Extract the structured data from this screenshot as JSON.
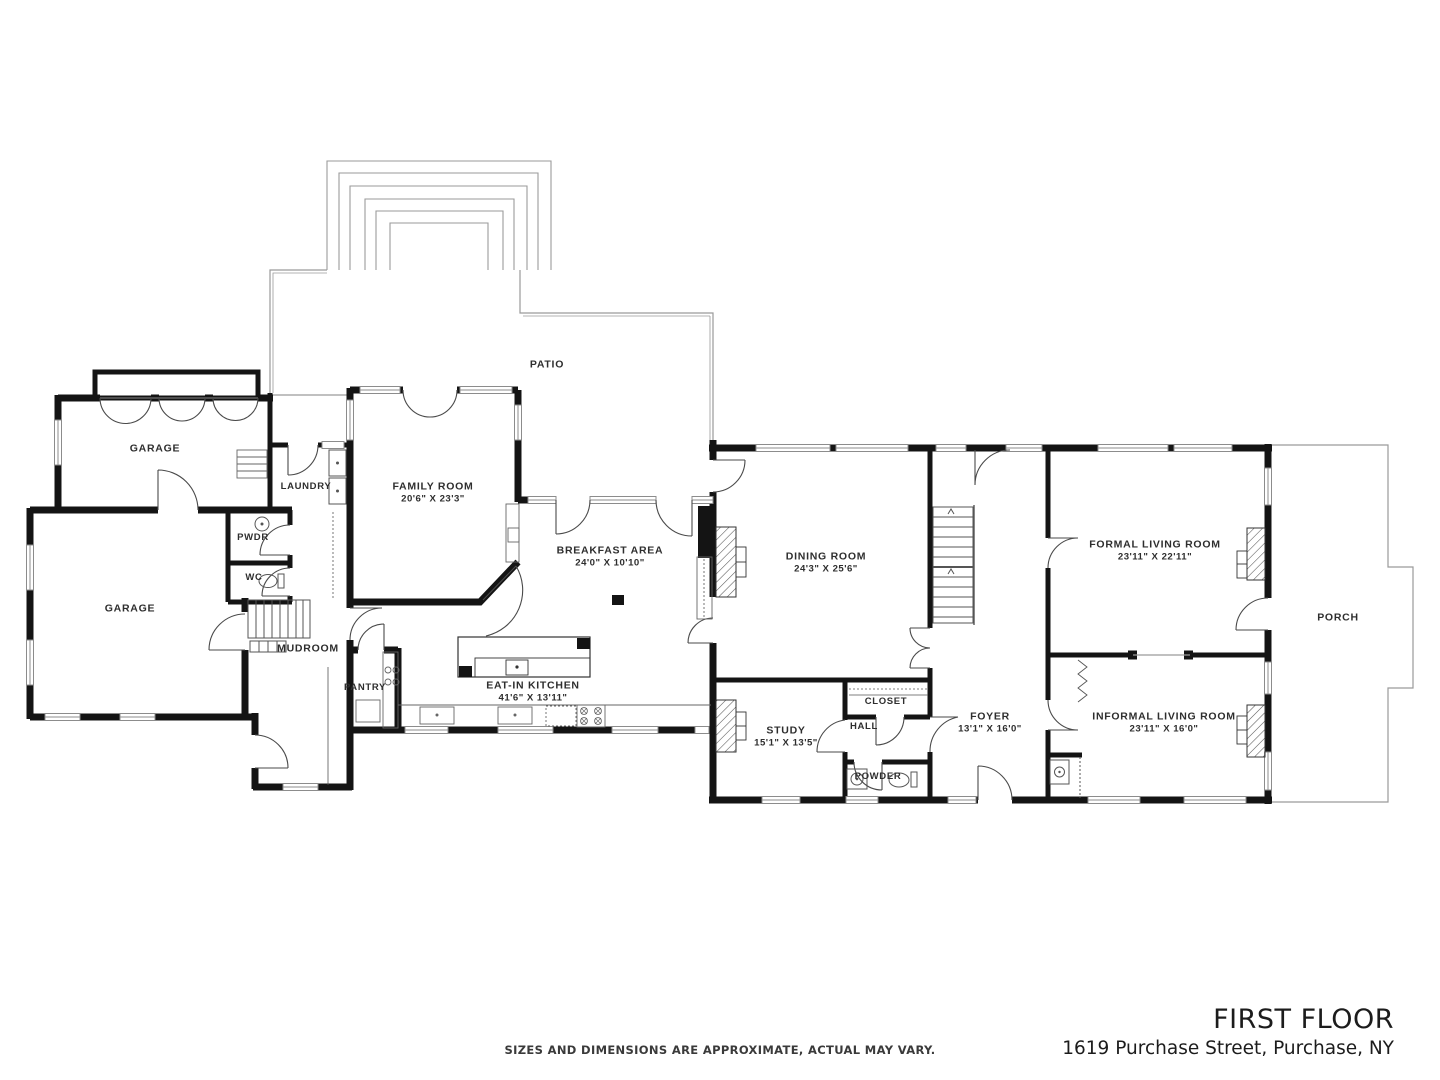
{
  "page": {
    "background": "#ffffff"
  },
  "footer": {
    "title": "FIRST FLOOR",
    "address": "1619 Purchase Street, Purchase, NY",
    "disclaimer": "SIZES AND DIMENSIONS ARE APPROXIMATE, ACTUAL MAY VARY."
  },
  "plan": {
    "colors": {
      "wall": "#141414",
      "thin_line": "#999999",
      "label_text": "#2e2e2e"
    },
    "rooms": [
      {
        "id": "garage-upper",
        "name": "GARAGE",
        "dims": ""
      },
      {
        "id": "garage-lower",
        "name": "GARAGE",
        "dims": ""
      },
      {
        "id": "laundry",
        "name": "LAUNDRY",
        "dims": ""
      },
      {
        "id": "pwdr",
        "name": "PWDR",
        "dims": ""
      },
      {
        "id": "wc",
        "name": "WC",
        "dims": ""
      },
      {
        "id": "mudroom",
        "name": "MUDROOM",
        "dims": ""
      },
      {
        "id": "pantry",
        "name": "PANTRY",
        "dims": ""
      },
      {
        "id": "family-room",
        "name": "FAMILY ROOM",
        "dims": "20'6\" X 23'3\""
      },
      {
        "id": "breakfast-area",
        "name": "BREAKFAST AREA",
        "dims": "24'0\" X 10'10\""
      },
      {
        "id": "eat-in-kitchen",
        "name": "EAT-IN KITCHEN",
        "dims": "41'6\" X 13'11\""
      },
      {
        "id": "patio",
        "name": "PATIO",
        "dims": ""
      },
      {
        "id": "dining-room",
        "name": "DINING ROOM",
        "dims": "24'3\" X 25'6\""
      },
      {
        "id": "study",
        "name": "STUDY",
        "dims": "15'1\" X 13'5\""
      },
      {
        "id": "closet",
        "name": "CLOSET",
        "dims": ""
      },
      {
        "id": "hall",
        "name": "HALL",
        "dims": ""
      },
      {
        "id": "powder",
        "name": "POWDER",
        "dims": ""
      },
      {
        "id": "foyer",
        "name": "FOYER",
        "dims": "13'1\" X 16'0\""
      },
      {
        "id": "formal-living-room",
        "name": "FORMAL LIVING ROOM",
        "dims": "23'11\" X 22'11\""
      },
      {
        "id": "informal-living-room",
        "name": "INFORMAL LIVING ROOM",
        "dims": "23'11\" X 16'0\""
      },
      {
        "id": "porch",
        "name": "PORCH",
        "dims": ""
      }
    ]
  }
}
